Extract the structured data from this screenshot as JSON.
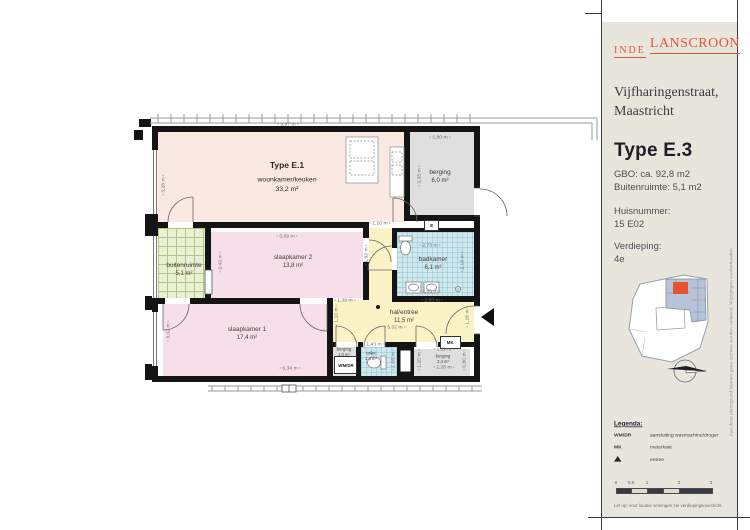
{
  "brand": {
    "name_left": "INDE",
    "name_right": "LANSCROON"
  },
  "project": {
    "street": "Vijfharingenstraat,",
    "city": "Maastricht"
  },
  "unit": {
    "type": "Type E.3",
    "gbo": "GBO: ca. 92,8 m2",
    "buitenruimte": "Buitenruimte: 5,1 m2",
    "huisnummer_label": "Huisnummer:",
    "huisnummer": "15 E02",
    "verdieping_label": "Verdieping:",
    "verdieping": "4e"
  },
  "legend": {
    "title": "Legenda:",
    "items": [
      {
        "key": "WM/DR",
        "desc": "aansluiting wasmachine/droger"
      },
      {
        "key": "MK",
        "desc": "meterkast"
      },
      {
        "key": "entree-triangle",
        "desc": "entree"
      }
    ],
    "scale_ticks": [
      "0",
      "0,5",
      "1",
      "2",
      "3"
    ],
    "note": "Let op: voor locatie woningen zie verdiepingsoverzicht."
  },
  "disclaimer": "Aan deze plattegrond kunnen geen rechten worden ontleend. Wijzigingen voorbehouden.",
  "plan": {
    "type_label": "Type E.1",
    "rooms": [
      {
        "name": "woonkamer/keuken",
        "area": "33,2 m²"
      },
      {
        "name": "slaapkamer 2",
        "area": "13,8 m²"
      },
      {
        "name": "slaapkamer 1",
        "area": "17,4 m²"
      },
      {
        "name": "buitenruimte",
        "area": "5,1 m²"
      },
      {
        "name": "berging",
        "area": "6,0 m²"
      },
      {
        "name": "badkamer",
        "area": "6,1 m²"
      },
      {
        "name": "hal/entree",
        "area": "11,5 m²"
      },
      {
        "name": "berging",
        "area": "1,0 m²"
      },
      {
        "name": "toilet",
        "area": "1,4 m²"
      },
      {
        "name": "berging",
        "area": "2,4 m²"
      }
    ],
    "boxes": {
      "wmdr": "WM/DR",
      "mk": "MK",
      "e": "E"
    },
    "dims": [
      "9,87 m",
      "1,80 m",
      "3,28 m",
      "5,69 m",
      "2,42 m",
      "3,33 m",
      "1,10 m",
      "2,73 m",
      "2,83 m",
      "2,18 m",
      "1,92 m",
      "1,39 m",
      "2,83 m",
      "5,32 m",
      "1,10 m",
      "1,16 m",
      "6,34 m",
      "3,02 m",
      "1,43 m",
      "1,08 m",
      "1,11 m",
      "2,28 m",
      "1,20 m",
      "0,80 m"
    ]
  },
  "colors": {
    "accent": "#e2553a",
    "panel": "#e8e6dc",
    "wall": "#141414",
    "living": "#f9e9e2",
    "bedroom": "#f6dfe9",
    "hall": "#fbf3c6",
    "storage": "#dfdfdf",
    "tiles": "#cfe8ee",
    "balcony": "#e9f0d2",
    "map_unit": "#e8512e",
    "map_block": "#b7c3d8"
  }
}
